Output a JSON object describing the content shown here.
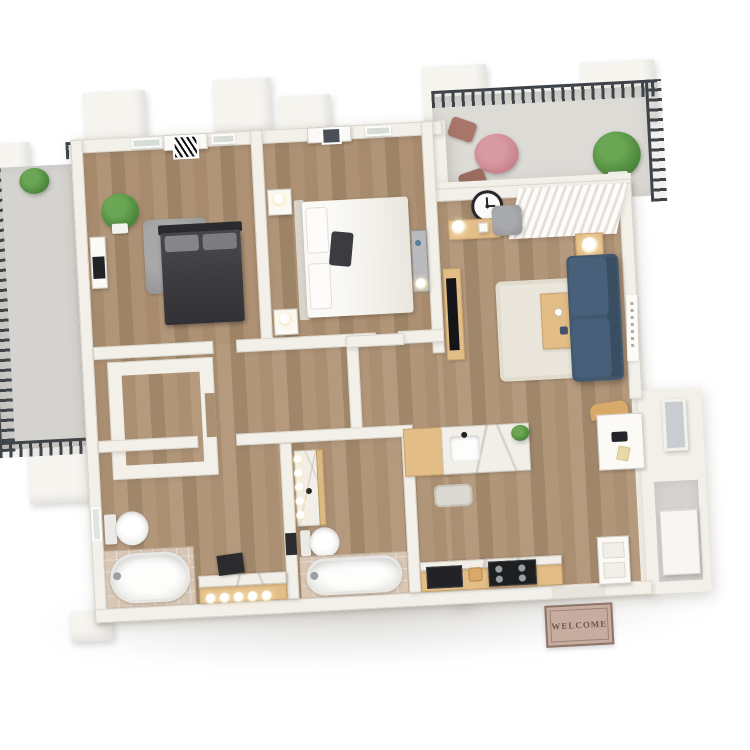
{
  "scene": {
    "type": "3d-floorplan-render",
    "view": "isometric top-down",
    "background": "#ffffff",
    "description": "White-walled two bedroom, two bathroom apartment render with wood floors, top balcony, side patio and entry welcome mat"
  },
  "doormat": {
    "text": "WELCOME"
  },
  "palette": {
    "wall": "#f3f0ea",
    "wall_edge": "#d9d3c9",
    "wood_floor": "#b2967a",
    "furniture_wood": "#e3bd86",
    "marble": "#f2efe9",
    "concrete": "#d5d3cf",
    "railing": "#3e4347",
    "sofa_navy": "#42586e",
    "bistro_pink": "#c9838d",
    "plant_green": "#4f8a3e",
    "charcoal_bed": "#3a3a3f",
    "gray_rug": "#9b9b9b",
    "cream_rug": "#eae6db",
    "tile_travertine": "#d8c7b4",
    "mat_base": "#c7aca0",
    "mat_border": "#8d7468",
    "mat_text": "#6b5a50",
    "appliance_black": "#202125",
    "window_glass": "#d6ddd6"
  },
  "rooms": [
    {
      "id": "bedroom-1",
      "furniture": [
        "dark-platform-bed",
        "gray-pillows",
        "shag-rug",
        "potted-plant",
        "media-cabinet",
        "zebra-art-door",
        "two-windows"
      ]
    },
    {
      "id": "bedroom-2",
      "furniture": [
        "white-bed",
        "charcoal-accent-pillow",
        "nightstand-lamp-top",
        "nightstand-lamp-bottom",
        "gray-dresser",
        "art-door",
        "window"
      ]
    },
    {
      "id": "living-room",
      "furniture": [
        "navy-sofa",
        "wood-coffee-table",
        "cream-rug",
        "cube-side-table-lamp",
        "console-table-lamp",
        "wall-clock",
        "gray-armchair",
        "vertical-blinds",
        "tv-on-console",
        "script-wall-art"
      ]
    },
    {
      "id": "kitchen",
      "furniture": [
        "marble-island-with-sink",
        "island-plant",
        "floor-mat",
        "counter-with-marble-top",
        "microwave",
        "bread-box",
        "gas-stove"
      ]
    },
    {
      "id": "bathroom-1",
      "furniture": [
        "toilet",
        "soaking-tub",
        "tiled-alcove",
        "vanity-with-bulb-lights",
        "dark-vanity-mirror",
        "window"
      ]
    },
    {
      "id": "bathroom-2",
      "furniture": [
        "vanity-with-bulb-lights",
        "toilet",
        "soaking-tub",
        "tiled-alcove",
        "dark-vanity-mirror"
      ]
    },
    {
      "id": "walk-in-closet",
      "furniture": []
    },
    {
      "id": "desk-nook",
      "furniture": [
        "white-desk",
        "wood-desk-chair",
        "laptop",
        "wall-mirror"
      ]
    },
    {
      "id": "entry",
      "furniture": [
        "open-entry-door",
        "welcome-doormat",
        "utility-appliance"
      ]
    },
    {
      "id": "balcony",
      "furniture": [
        "pink-bistro-table",
        "two-bistro-chairs",
        "large-potted-plant",
        "metal-railing"
      ]
    },
    {
      "id": "patio",
      "furniture": [
        "metal-railing",
        "white-pillars"
      ]
    }
  ]
}
